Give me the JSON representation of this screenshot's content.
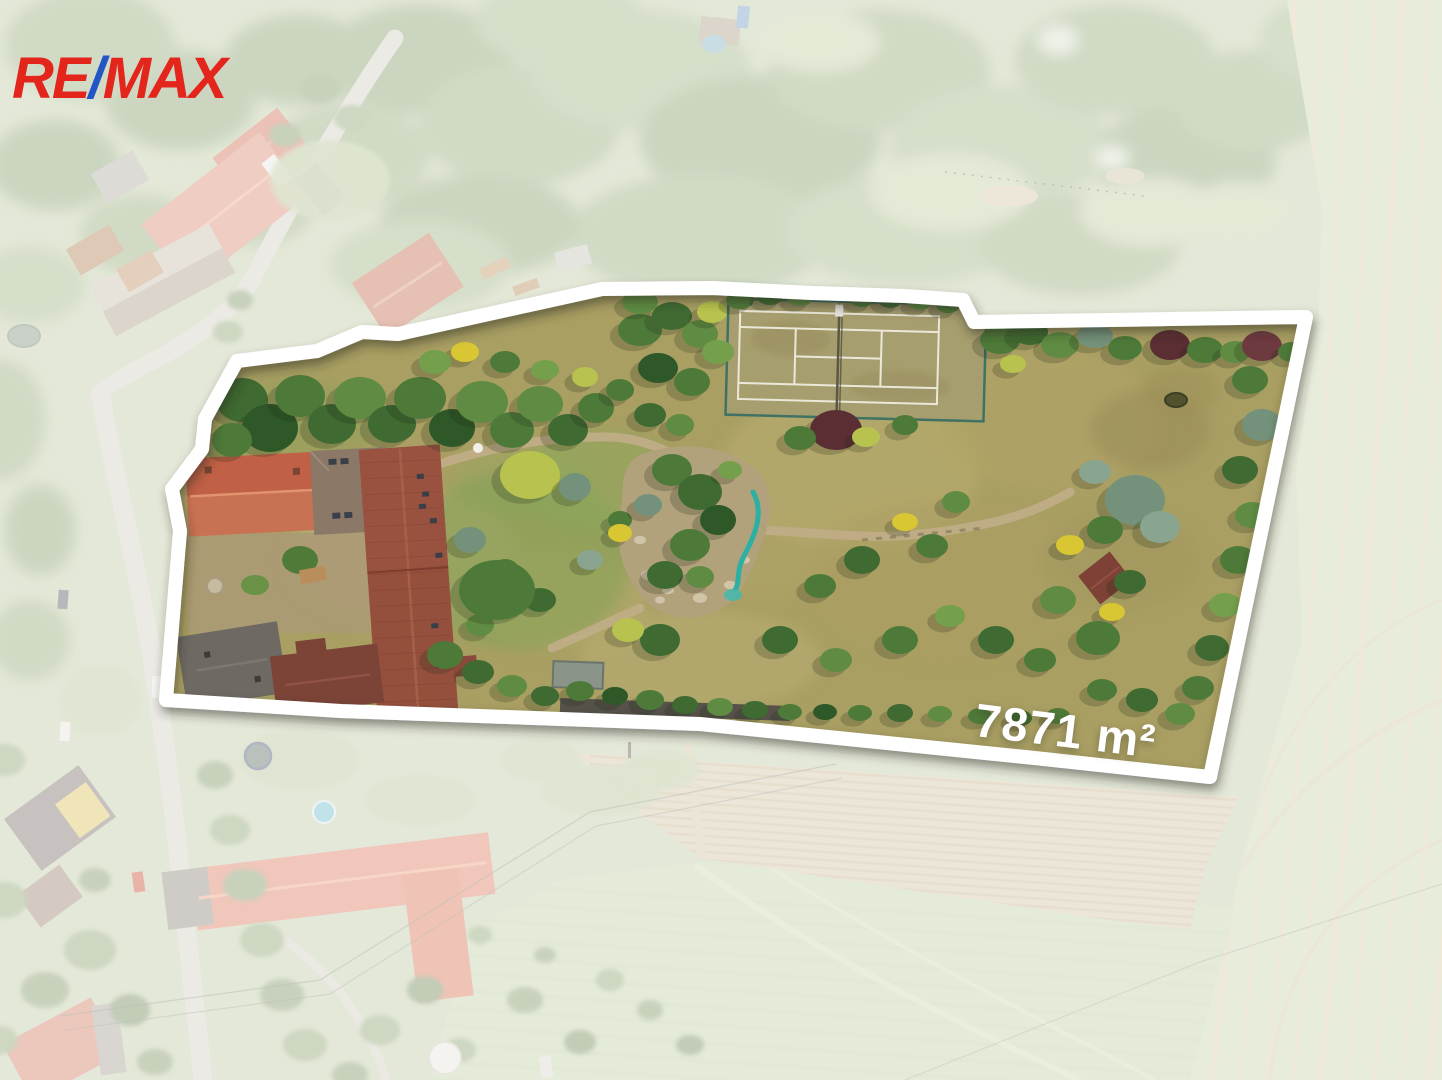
{
  "brand": {
    "name": "RE/MAX",
    "re": "RE",
    "slash": "/",
    "max": "MAX",
    "red": "#e3251c",
    "blue": "#2355c5"
  },
  "property": {
    "area_label": "7871 m²",
    "boundary_color": "#ffffff"
  }
}
